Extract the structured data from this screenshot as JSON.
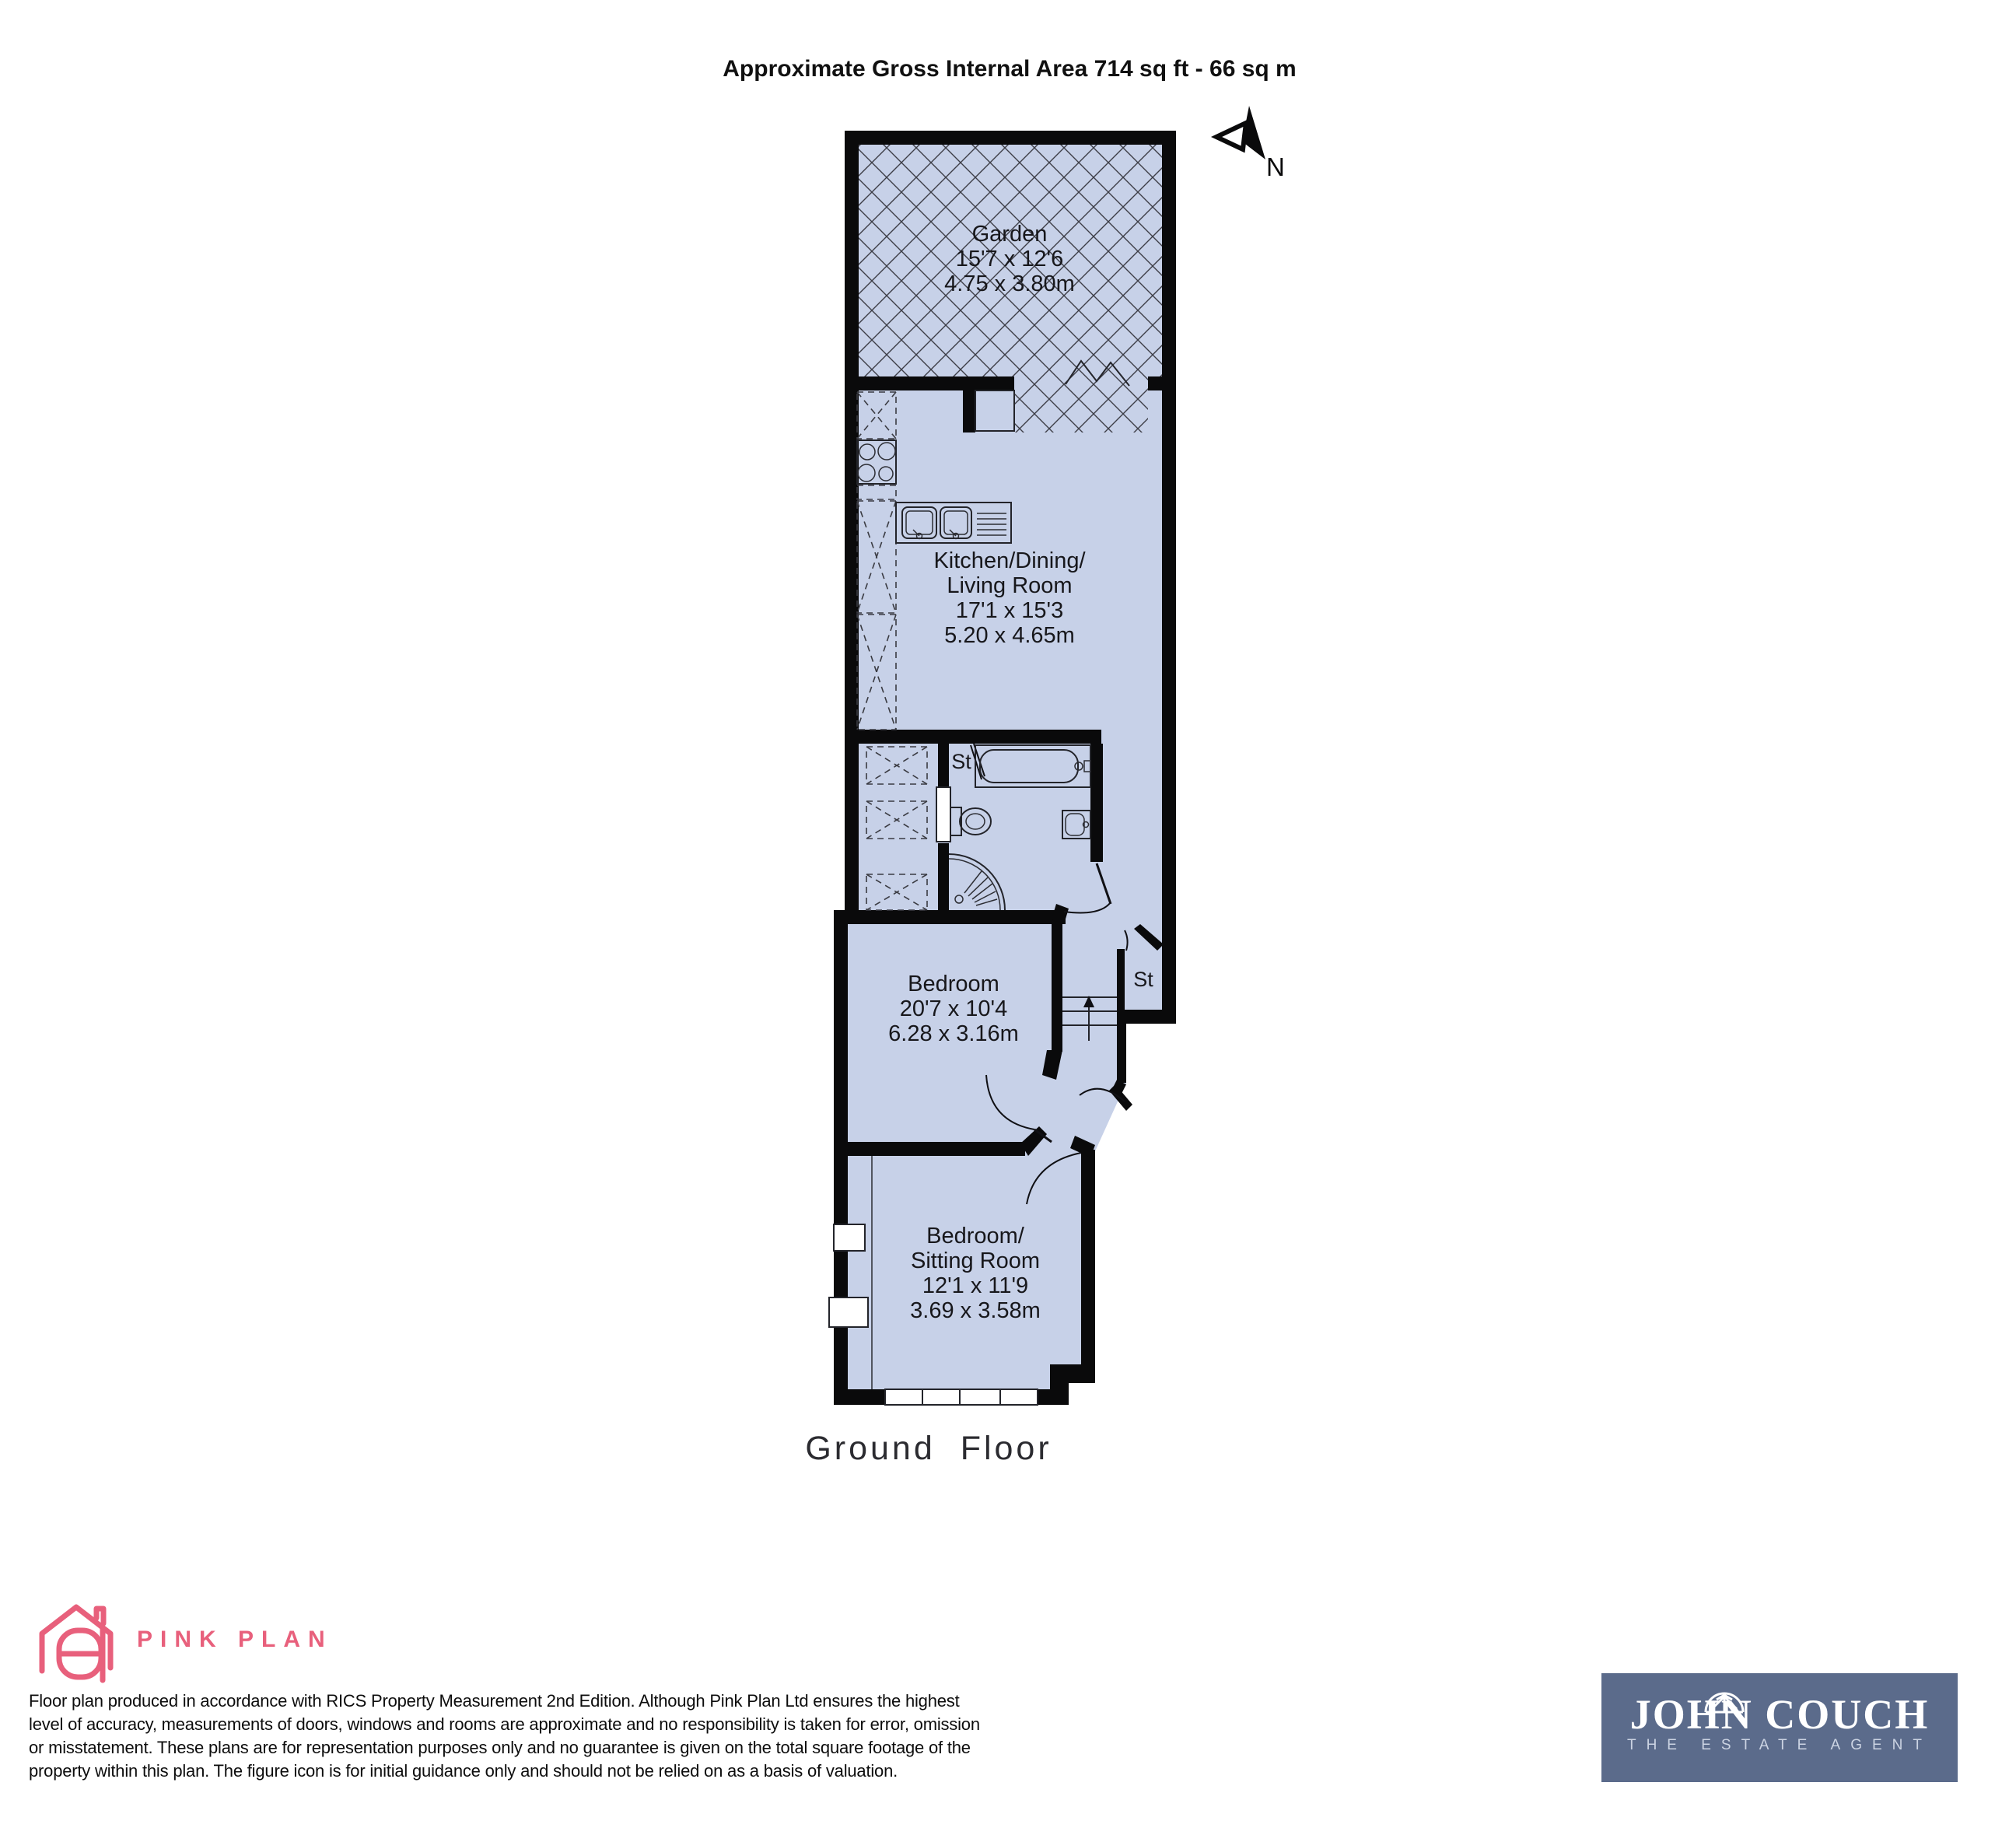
{
  "title": "Approximate Gross Internal Area 714 sq ft - 66 sq m",
  "compass_label": "N",
  "plan": {
    "garden": {
      "name": "Garden",
      "imperial": "15'7 x 12'6",
      "metric": "4.75 x 3.80m"
    },
    "kitchen": {
      "line1": "Kitchen/Dining/",
      "line2": "Living Room",
      "imperial": "17'1 x 15'3",
      "metric": "5.20 x 4.65m"
    },
    "bedroom": {
      "name": "Bedroom",
      "imperial": "20'7 x 10'4",
      "metric": "6.28 x 3.16m"
    },
    "sitting_room": {
      "line1": "Bedroom/",
      "line2": "Sitting Room",
      "imperial": "12'1 x 11'9",
      "metric": "3.69 x 3.58m"
    },
    "storage_bathroom": "St",
    "storage_hall": "St",
    "floor_label": "Ground Floor"
  },
  "pink_plan": {
    "brand": "PINK PLAN",
    "color": "#e8607c"
  },
  "disclaimer": {
    "line1": "Floor plan produced in accordance with RICS Property Measurement 2nd Edition. Although Pink Plan Ltd ensures the highest",
    "line2": "level of accuracy, measurements of doors, windows and rooms are approximate and no responsibility is taken for error, omission",
    "line3": "or misstatement. These plans are for representation purposes only and no guarantee is given on the total square footage of the",
    "line4": "property within this plan. The figure icon is for initial guidance only and should not be relied on as a basis of valuation."
  },
  "agent": {
    "name": "JOHN COUCH",
    "tagline": "THE ESTATE AGENT",
    "bg_color": "#5b6b8b"
  },
  "colors": {
    "floor_fill": "#c7d1e8",
    "wall": "#0a0a0b",
    "brand_pink": "#e8607c",
    "agent_navy": "#5b6b8b"
  }
}
